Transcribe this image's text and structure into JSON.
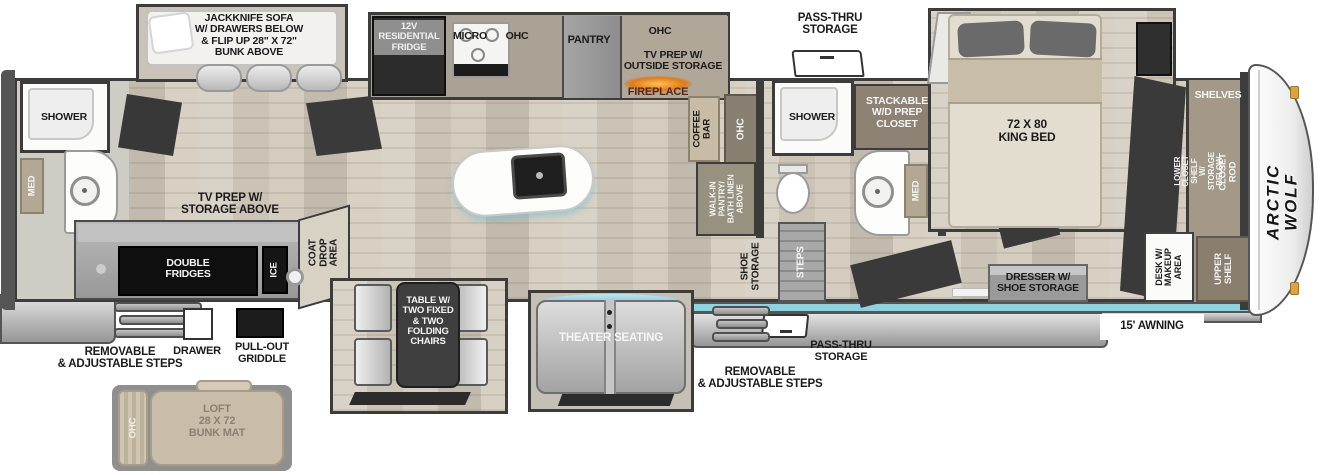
{
  "brand": {
    "name": "ARCTIC WOLF"
  },
  "exterior": {
    "pass_thru_top": "PASS-THRU\nSTORAGE",
    "pass_thru_bottom": "PASS-THRU\nSTORAGE",
    "awning": "15' AWNING",
    "steps_left": "REMOVABLE\n& ADJUSTABLE STEPS",
    "steps_right": "REMOVABLE\n& ADJUSTABLE STEPS",
    "drawer": "DRAWER",
    "griddle": "PULL-OUT\nGRIDDLE"
  },
  "living": {
    "sofa": "JACKKNIFE SOFA\nW/ DRAWERS BELOW\n& FLIP UP 28\" X 72\"\nBUNK ABOVE",
    "tv_prep": "TV PREP W/\nSTORAGE ABOVE",
    "coat_drop": "COAT DROP\nAREA",
    "double_fridges": "DOUBLE\nFRIDGES",
    "ice": "ICE",
    "table": "TABLE W/\nTWO FIXED\n& TWO\nFOLDING\nCHAIRS",
    "theater": "THEATER SEATING",
    "fireplace": "FIREPLACE",
    "coffee_bar": "COFFEE\nBAR",
    "ohc_coffee": "OHC"
  },
  "kitchen": {
    "fridge": "12V\nRESIDENTIAL\nFRIDGE",
    "micro": "MICRO",
    "ohc1": "OHC",
    "pantry": "PANTRY",
    "ohc2": "OHC",
    "tv_prep_outside": "TV PREP W/\nOUTSIDE STORAGE"
  },
  "rear_bath": {
    "shower": "SHOWER",
    "med": "MED"
  },
  "mid_bath": {
    "shower": "SHOWER",
    "med": "MED",
    "walk_in": "WALK-IN\nPANTRY/\nBATH LINEN\nABOVE",
    "laundry": "STACKABLE\nW/D PREP\nCLOSET",
    "steps": "STEPS",
    "shoe_storage": "SHOE\nSTORAGE"
  },
  "bedroom": {
    "bed": "72 X 80\nKING BED",
    "dresser": "DRESSER W/\nSHOE STORAGE",
    "desk": "DESK W/\nMAKEUP\nAREA",
    "upper_shelf": "UPPER\nSHELF",
    "shelves": "SHELVES",
    "closet_rod": "CLOSET ROD",
    "lower_closet": "LOWER CLOSET SHELF\nW/ STORAGE BELOW"
  },
  "loft": {
    "label": "LOFT\n28 X 72\nBUNK MAT",
    "ohc": "OHC"
  },
  "colors": {
    "accent_blue": "#8ed2e0",
    "fireplace_orange": "#e07b1a",
    "wall": "#3c3c3c"
  }
}
